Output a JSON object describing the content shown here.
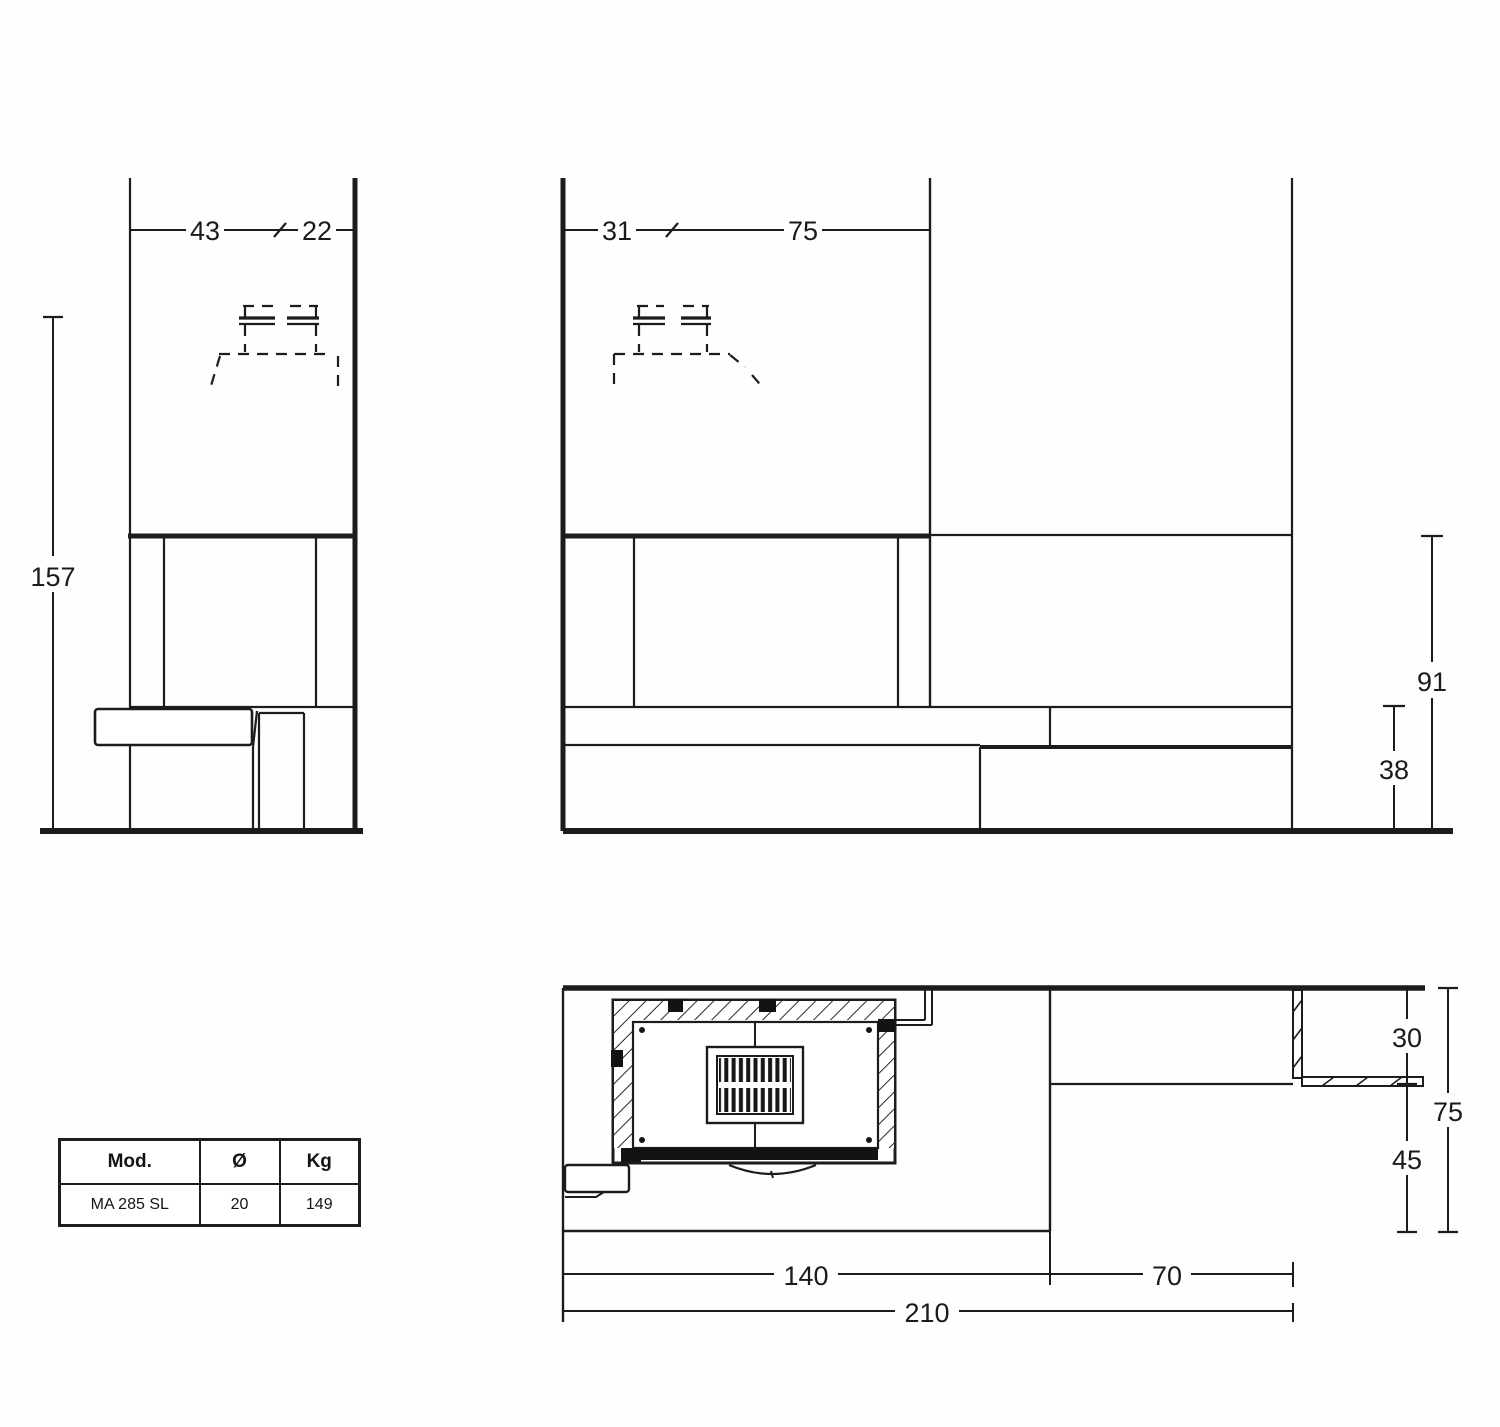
{
  "side_view": {
    "width_left": "43",
    "width_right": "22",
    "height_total": "157"
  },
  "front_view": {
    "width_left": "31",
    "width_right": "75",
    "height_hood": "91",
    "height_hearth": "38"
  },
  "plan_view": {
    "depth_top": "30",
    "depth_front": "45",
    "depth_total": "75",
    "width_main": "140",
    "width_side": "70",
    "width_total": "210"
  },
  "table": {
    "headers": [
      "Mod.",
      "Ø",
      "Kg"
    ],
    "row": [
      "MA 285 SL",
      "20",
      "149"
    ]
  }
}
